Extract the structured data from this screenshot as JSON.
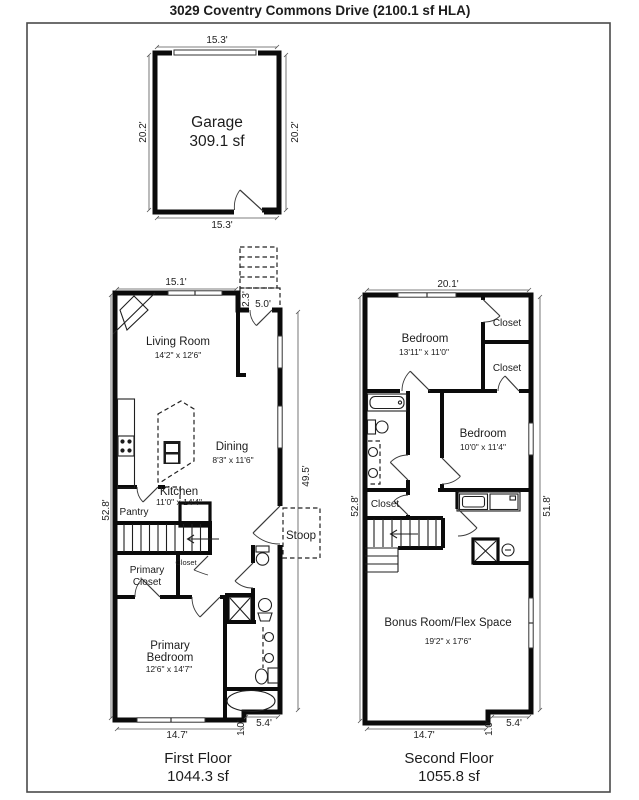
{
  "page": {
    "title": "3029 Coventry Commons Drive (2100.1 sf HLA)"
  },
  "garage": {
    "name": "Garage",
    "area": "309.1 sf",
    "dim_top": "15.3'",
    "dim_bottom": "15.3'",
    "dim_left": "20.2'",
    "dim_right": "20.2'"
  },
  "first_floor": {
    "label": "First Floor",
    "area": "1044.3 sf",
    "dim_top": "15.1'",
    "dim_left": "52.8'",
    "dim_right": "49.5'",
    "dim_bottom": "14.7'",
    "dim_bottom_jog": "1.0'",
    "dim_bottom_right": "5.4'",
    "dim_entry_depth": "2.3'",
    "dim_entry_width": "5.0'",
    "living_room": {
      "name": "Living Room",
      "size": "14'2\" x 12'6\""
    },
    "dining": {
      "name": "Dining",
      "size": "8'3\" x 11'6\""
    },
    "kitchen": {
      "name": "Kitchen",
      "size": "11'0\" x 14'4\""
    },
    "pantry": {
      "name": "Pantry"
    },
    "stoop": {
      "name": "Stoop"
    },
    "closet": {
      "name": "Closet"
    },
    "primary_closet": {
      "line1": "Primary",
      "line2": "Closet"
    },
    "primary_bedroom": {
      "line1": "Primary",
      "line2": "Bedroom",
      "size": "12'6\" x 14'7\""
    }
  },
  "second_floor": {
    "label": "Second Floor",
    "area": "1055.8 sf",
    "dim_top": "20.1'",
    "dim_left": "52.8'",
    "dim_right": "51.8'",
    "dim_bottom": "14.7'",
    "dim_bottom_jog": "1.0'",
    "dim_bottom_right": "5.4'",
    "bedroom1": {
      "name": "Bedroom",
      "size": "13'11\" x 11'0\""
    },
    "bedroom2": {
      "name": "Bedroom",
      "size": "10'0\" x 11'4\""
    },
    "closet1": {
      "name": "Closet"
    },
    "closet2": {
      "name": "Closet"
    },
    "closet3": {
      "name": "Closet"
    },
    "bonus_room": {
      "name": "Bonus Room/Flex Space",
      "size": "19'2\" x 17'6\""
    }
  }
}
